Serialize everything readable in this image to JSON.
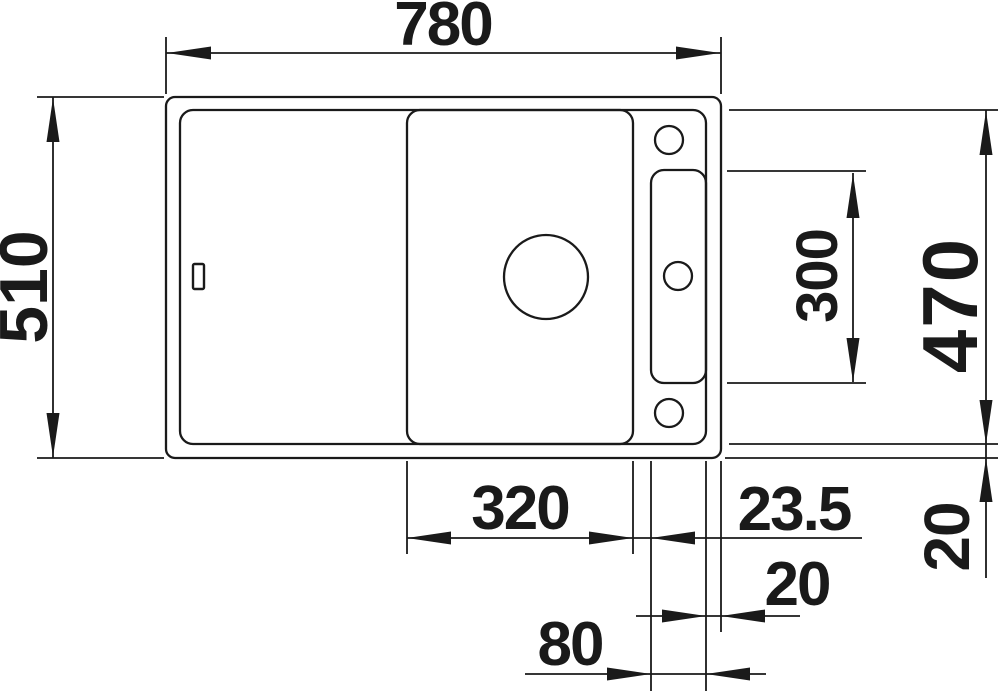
{
  "drawing": {
    "subject": "kitchen-sink-top-view-dimension-drawing",
    "background": "#ffffff",
    "line_color": "#1a1a1a",
    "dimensions": {
      "overall_width": "780",
      "overall_depth": "510",
      "inner_depth_right": "470",
      "ledge_tray_length": "300",
      "bowl_width": "320",
      "bowl_to_tray_gap": "23.5",
      "tray_width": "80",
      "rim_right_width": "20",
      "rim_bottom_width": "20"
    }
  }
}
